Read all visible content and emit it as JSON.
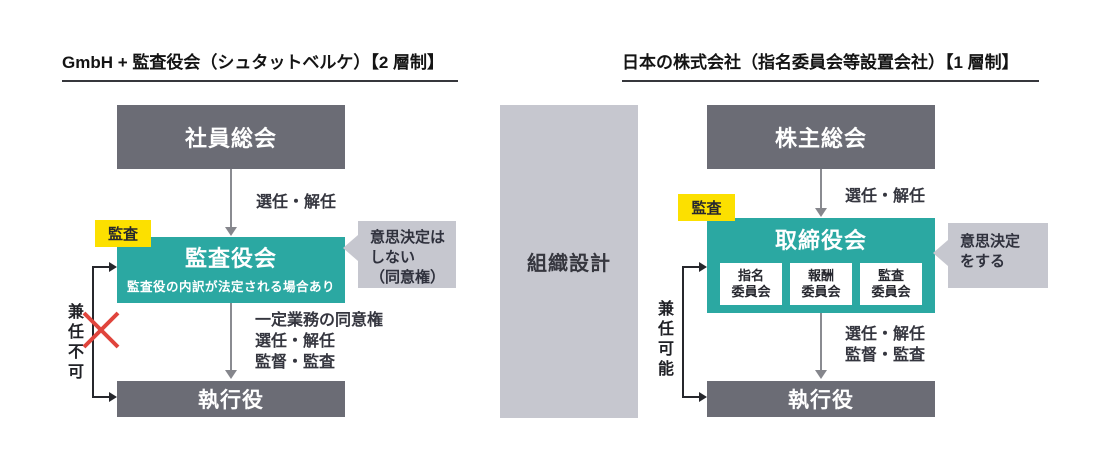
{
  "colors": {
    "teal": "#2BA8A2",
    "dark_gray_box": "#6B6C75",
    "light_gray_box": "#C6C7CF",
    "highlight_yellow": "#FCE000",
    "cross_red": "#E0443C"
  },
  "left_panel": {
    "title": "GmbH + 監査役会（シュタットベルケ）【2 層制】",
    "top_box": "社員総会",
    "appoint_label": "選任・解任",
    "audit_tag": "監査",
    "board_title": "監査役会",
    "board_subtitle": "監査役の内訳が法定される場合あり",
    "callout": {
      "line1": "意思決定は",
      "line2": "しない",
      "line3": "（同意権）"
    },
    "down_labels": {
      "line1": "一定業務の同意権",
      "line2": "選任・解任",
      "line3": "監督・監査"
    },
    "bottom_box": "執行役",
    "side_label": "兼任不可"
  },
  "center": {
    "label": "組織設計"
  },
  "right_panel": {
    "title": "日本の株式会社（指名委員会等設置会社）【1 層制】",
    "top_box": "株主総会",
    "appoint_label": "選任・解任",
    "audit_tag": "監査",
    "board_title": "取締役会",
    "committees": [
      {
        "line1": "指名",
        "line2": "委員会"
      },
      {
        "line1": "報酬",
        "line2": "委員会"
      },
      {
        "line1": "監査",
        "line2": "委員会"
      }
    ],
    "callout": {
      "line1": "意思決定",
      "line2": "をする"
    },
    "down_labels": {
      "line1": "選任・解任",
      "line2": "監督・監査"
    },
    "bottom_box": "執行役",
    "side_label": "兼任可能"
  }
}
